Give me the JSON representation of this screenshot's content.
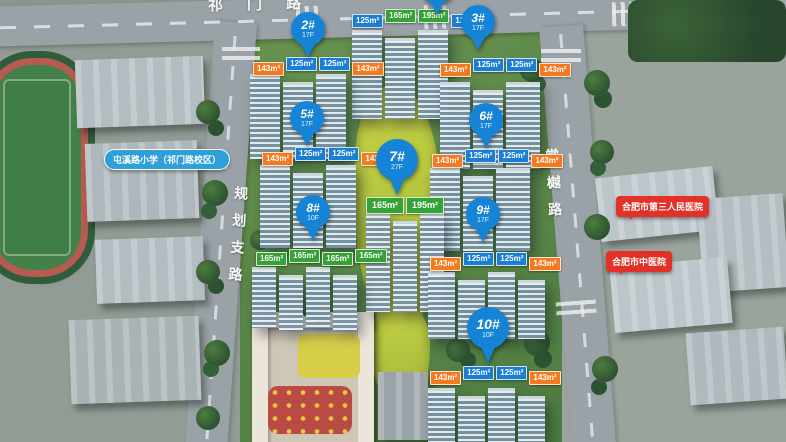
{
  "roads": {
    "top": "祁门路",
    "left": "规划支路",
    "right": "棠樾路"
  },
  "landmarks": {
    "school": "屯溪路小学（祁门路校区）",
    "hospital_third": "合肥市第三人民医院",
    "hospital_tcm": "合肥市中医院"
  },
  "pins": {
    "p2": {
      "label": "2#",
      "sub": "17F"
    },
    "p3": {
      "label": "3#",
      "sub": "17F"
    },
    "p5": {
      "label": "5#",
      "sub": "17F"
    },
    "p6": {
      "label": "6#",
      "sub": "17F"
    },
    "p7": {
      "label": "7#",
      "sub": "27F"
    },
    "p8": {
      "label": "8#",
      "sub": "10F"
    },
    "p9": {
      "label": "9#",
      "sub": "17F"
    },
    "p10": {
      "label": "10#",
      "sub": "10F"
    }
  },
  "tags": {
    "b1": [
      "125m²",
      "165m²",
      "195m²",
      "125m²"
    ],
    "b2": [
      "143m²",
      "125m²",
      "125m²",
      "143m²"
    ],
    "b3": [
      "143m²",
      "125m²",
      "125m²",
      "143m²"
    ],
    "b5": [
      "143m²",
      "125m²",
      "125m²",
      "143m²"
    ],
    "b6": [
      "143m²",
      "125m²",
      "125m²",
      "143m²"
    ],
    "b7": [
      "165m²",
      "195m²"
    ],
    "b8": [
      "165m²",
      "165m²",
      "165m²",
      "165m²"
    ],
    "b9": [
      "143m²",
      "125m²",
      "125m²",
      "143m²"
    ],
    "b10": [
      "143m²",
      "125m²",
      "125m²",
      "143m²"
    ]
  },
  "colors": {
    "pin_blue": "#1583d6",
    "tag_orange": "#f4791f",
    "tag_blue": "#1a7fd4",
    "tag_green": "#35a235",
    "school_label": "#2e9fd8",
    "hospital_label": "#e23128"
  }
}
